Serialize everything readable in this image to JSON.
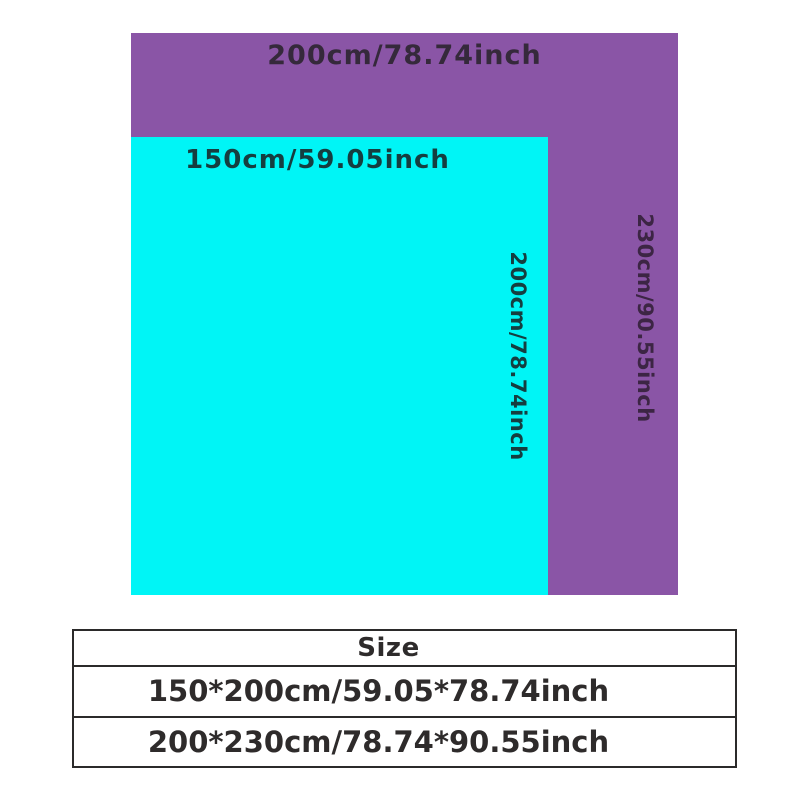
{
  "colors": {
    "background": "#ffffff",
    "purple": "#8a55a6",
    "cyan": "#00f5f6",
    "label_on_purple": "#35293b",
    "label_on_cyan": "#153e40",
    "vertical_label_on_purple": "#3c2544",
    "table_text": "#2e2b2b",
    "table_border": "#2b2a2a"
  },
  "diagram": {
    "large_rect": {
      "width_label": "200cm/78.74inch",
      "height_label": "230cm/90.55inch"
    },
    "small_rect": {
      "width_label": "150cm/59.05inch",
      "height_label": "200cm/78.74inch"
    }
  },
  "size_table": {
    "header": "Size",
    "rows": [
      "150*200cm/59.05*78.74inch",
      "200*230cm/78.74*90.55inch"
    ]
  }
}
